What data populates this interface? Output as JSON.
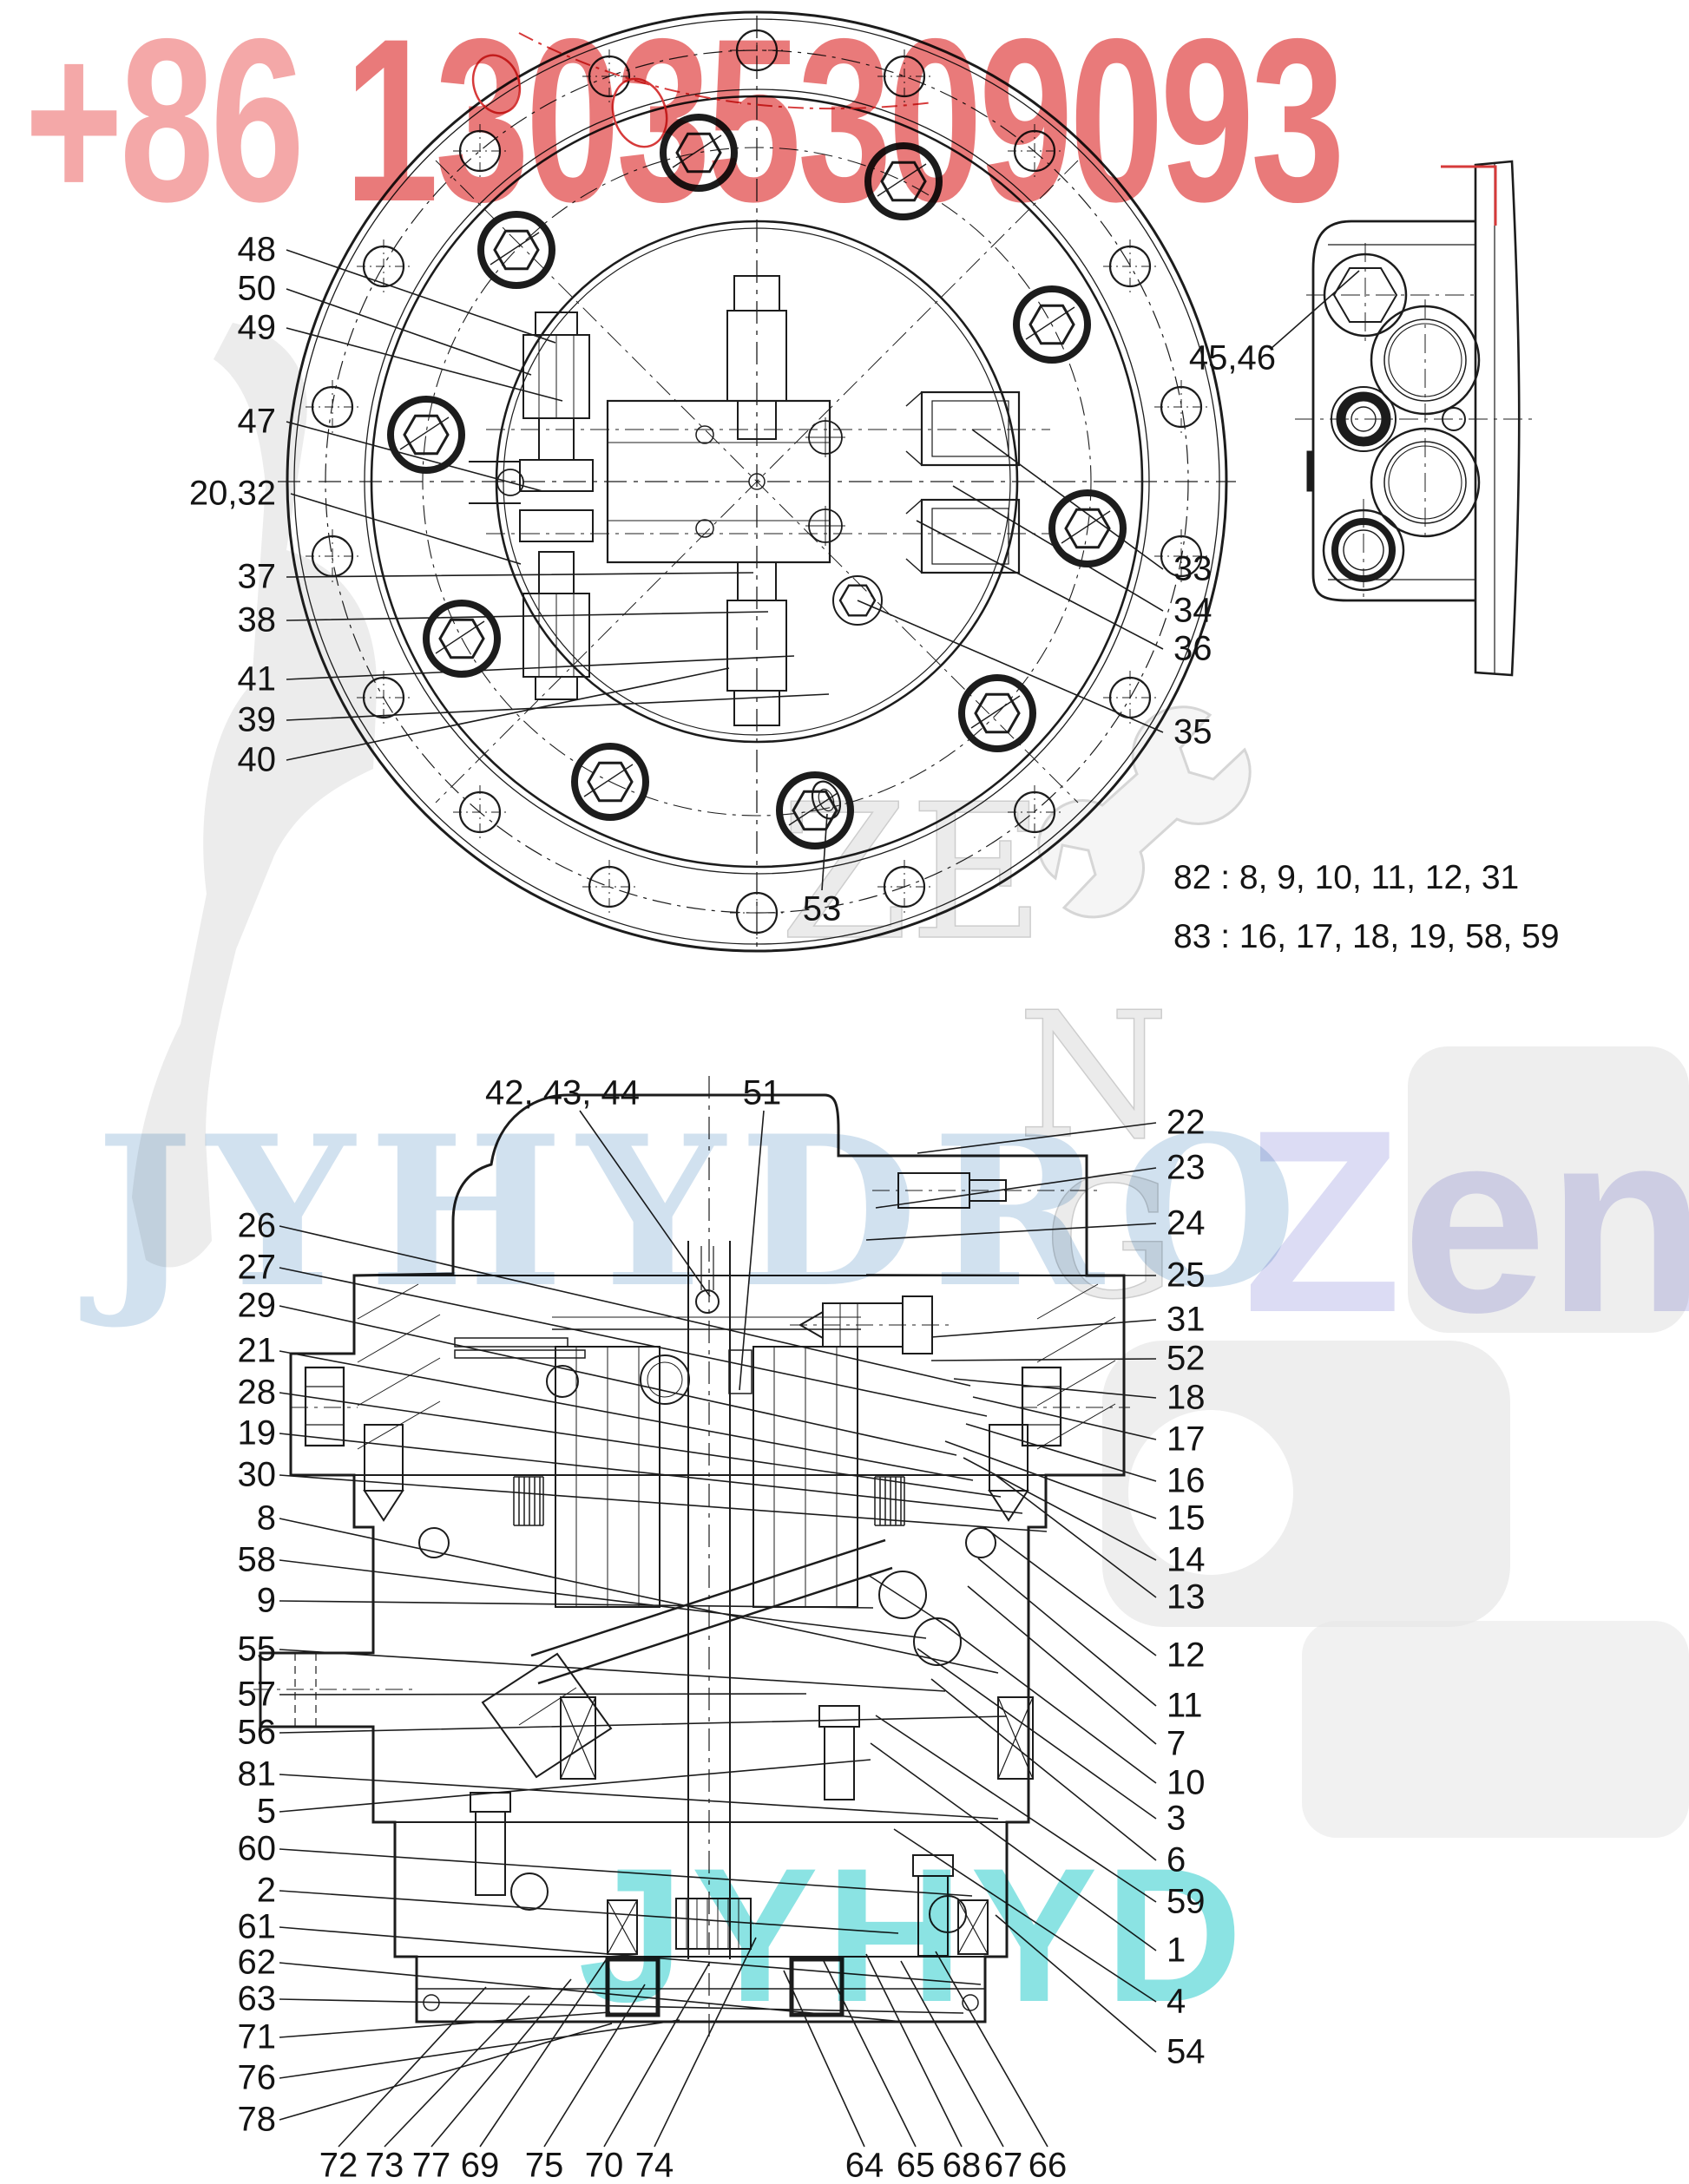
{
  "watermarks": {
    "phone_prefix": "+86 ",
    "phone_number": "13035309093",
    "brand_left": "JYHYDRO",
    "brand_right": "Zeng",
    "brand_bottom": "JYHYD",
    "letter_ze": "ZE",
    "letter_n": "N",
    "letter_g": "G",
    "colors": {
      "phone_pink": "#f3a3a3",
      "phone_red": "#e56363",
      "brand_blue": "#8cb4d8",
      "brand_lavender": "#c6c6ee",
      "brand_cyan": "#2ccccc",
      "drawing_line": "#1c1c1c",
      "annotation_red": "#d63a3a",
      "watermark_gray": "#dcdcdc"
    }
  },
  "top_view": {
    "left_labels": [
      "48",
      "50",
      "49",
      "47",
      "20,32",
      "37",
      "38",
      "41",
      "39",
      "40"
    ],
    "right_labels": [
      "33",
      "34",
      "36",
      "35"
    ],
    "bottom_label": "53"
  },
  "side_view": {
    "label": "45,46"
  },
  "notes": [
    "82 : 8, 9, 10, 11, 12, 31",
    "83 : 16, 17, 18, 19, 58, 59"
  ],
  "section_view": {
    "top_labels": [
      "42, 43, 44",
      "51"
    ],
    "left_labels": [
      "26",
      "27",
      "29",
      "21",
      "28",
      "19",
      "30",
      "8",
      "58",
      "9",
      "55",
      "57",
      "56",
      "81",
      "5",
      "60",
      "2",
      "61",
      "62",
      "63",
      "71",
      "76",
      "78"
    ],
    "right_labels": [
      "22",
      "23",
      "24",
      "25",
      "31",
      "52",
      "18",
      "17",
      "16",
      "15",
      "14",
      "13",
      "12",
      "11",
      "7",
      "10",
      "3",
      "6",
      "59",
      "1",
      "4",
      "54"
    ],
    "bottom_labels": [
      "72",
      "73",
      "77",
      "69",
      "75",
      "70",
      "74",
      "64",
      "65",
      "68",
      "67",
      "66"
    ]
  }
}
